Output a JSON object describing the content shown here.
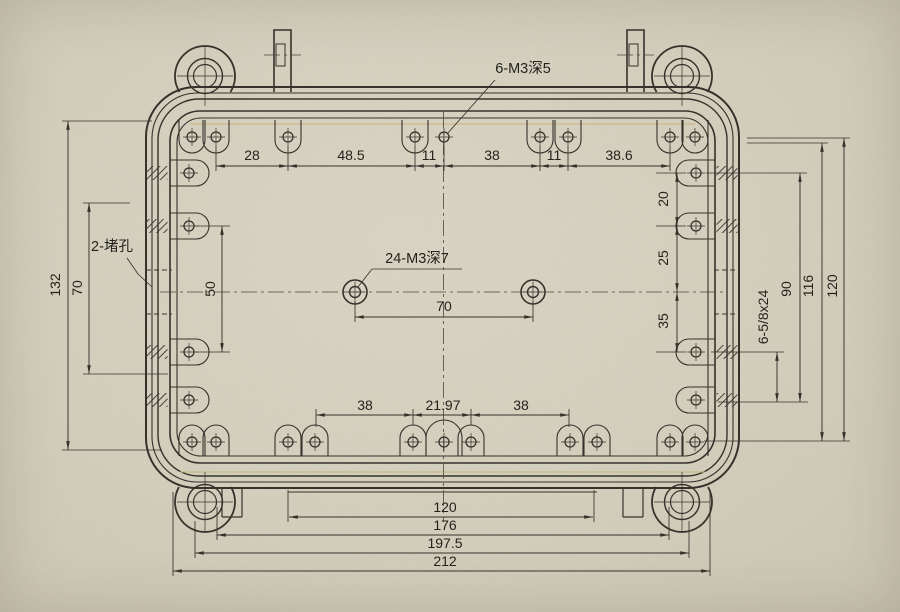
{
  "drawing": {
    "callouts": {
      "top_holes": "6-M3深5",
      "center_holes": "24-M3深7",
      "plug_holes": "2-堵孔",
      "connector_holes": "6-5/8x24"
    },
    "dims": {
      "top": [
        "28",
        "48.5",
        "11",
        "38",
        "11",
        "38.6"
      ],
      "left_overall": "132",
      "left_inner": "70",
      "left_lug_spacing": "50",
      "center_spacing": "70",
      "right_row1": "20",
      "right_row2": "25",
      "right_row3": "35",
      "right_span": "90",
      "right_inner_height": "116",
      "right_outer_height": "120",
      "bottom_slots": [
        "38",
        "21.97",
        "38"
      ],
      "bottom_flange": "120",
      "bottom_lug_span": "176",
      "bottom_step": "197.5",
      "bottom_overall": "212"
    },
    "colors": {
      "line": "#35322c",
      "paper": "#d7d2c0",
      "accent_red": "#5c3b3e",
      "accent_yellow": "#c6b578"
    }
  }
}
